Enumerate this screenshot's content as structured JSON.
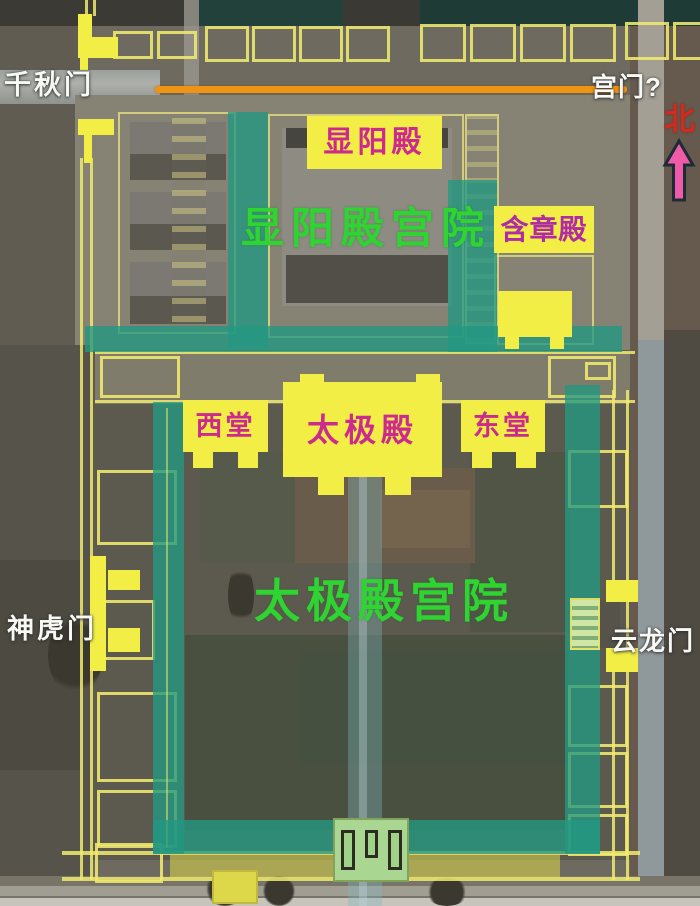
{
  "labels": {
    "gate_qianqiu": "千秋门",
    "gate_gongmen": "宫门?",
    "north": "北",
    "hall_xianyang": "显阳殿",
    "court_xianyang": "显阳殿宫院",
    "hall_hanzhang": "含章殿",
    "hall_west": "西堂",
    "hall_taiji": "太极殿",
    "hall_east": "东堂",
    "court_taiji": "太极殿宫院",
    "gate_shenhu": "神虎门",
    "gate_yunlong": "云龙门"
  },
  "colors": {
    "overlay_teal": "#229881",
    "axis_band": "#82b9c0",
    "hall_fill_yellow": "#f2ee45",
    "outline_yellow": "#f0eb6e",
    "orange_axis_line": "#ef9414",
    "court_text_green": "#2fd332",
    "hall_text_magenta": "#cc2a8e",
    "hanzhang_text_purple": "#b02ba4",
    "gate_text_white": "#f8f8f4",
    "north_text_red": "#d4291d",
    "north_arrow_pink": "#f05ba8"
  }
}
